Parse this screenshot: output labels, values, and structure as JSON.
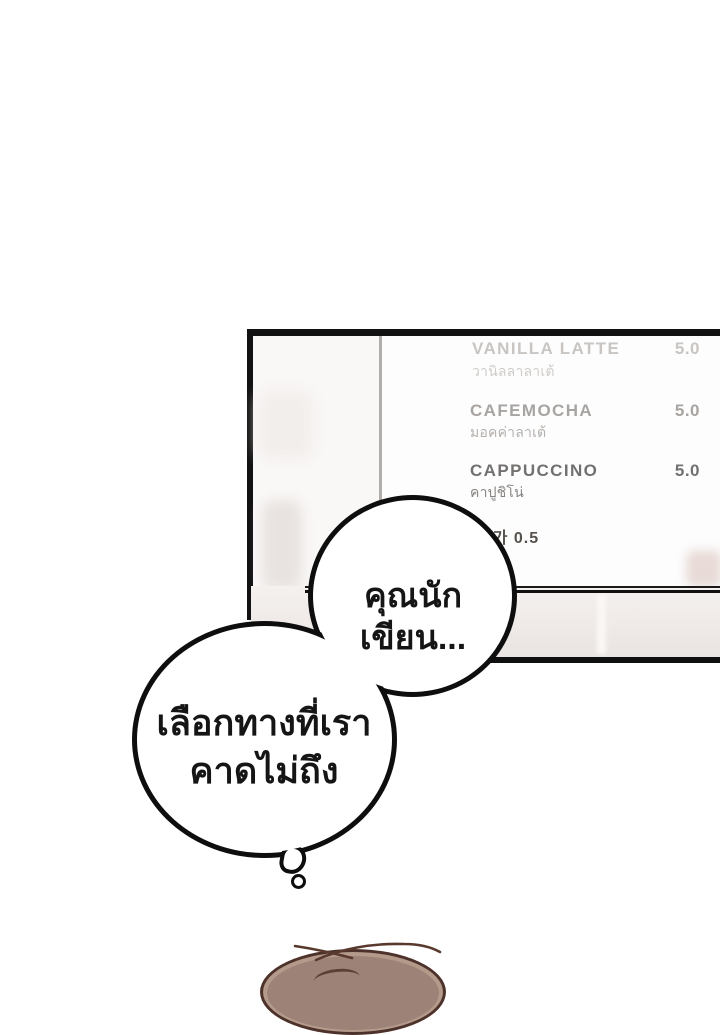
{
  "menu_board": {
    "items": [
      {
        "name": "VANILLA LATTE",
        "subtitle": "วานิลลาลาเต้",
        "price": "5.0"
      },
      {
        "name": "CAFEMOCHA",
        "subtitle": "มอคค่าลาเต้",
        "price": "5.0"
      },
      {
        "name": "CAPPUCCINO",
        "subtitle": "คาปูชิโน่",
        "price": "5.0"
      }
    ],
    "addon_note": "추가 0.5"
  },
  "speech": {
    "bubble1": {
      "text": "คุณนักเขียน..."
    },
    "bubble2": {
      "lines": [
        "เลือกทางที่เรา",
        "คาดไม่ถึง"
      ]
    }
  },
  "colors": {
    "bubble_outline": "#0e0e0e",
    "menu_row_faded": "#c8c5c2",
    "menu_row_mid": "#a8a4a1",
    "menu_row_dark": "#737070",
    "counter_face": "#efeae7",
    "hair_fill": "#9d8377",
    "hair_outline": "#4c322a"
  }
}
